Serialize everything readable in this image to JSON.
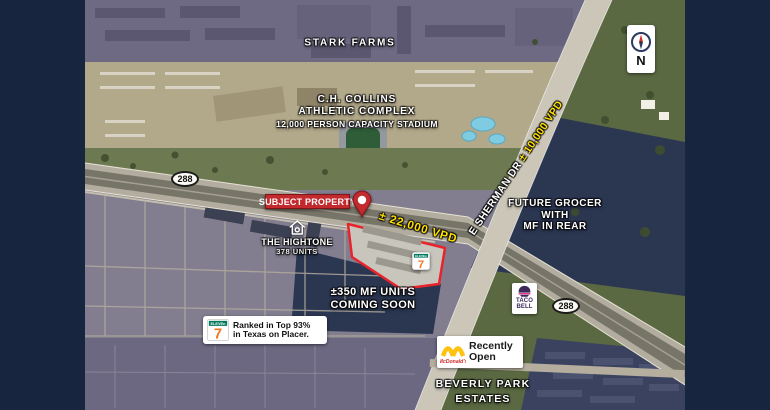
{
  "frame": {
    "border_color": "#17253e"
  },
  "labels": {
    "stark_farms": "STARK FARMS",
    "collins_line1": "C.H. COLLINS",
    "collins_line2": "ATHLETIC COMPLEX",
    "collins_line3": "12,000 PERSON CAPACITY STADIUM",
    "subject_property": "SUBJECT PROPERTY",
    "vpd_288": "± 22,000 VPD",
    "hightone_name": "THE HIGHTONE",
    "hightone_units": "378 UNITS",
    "sherman_name": "E SHERMAN DR",
    "sherman_vpd": " ± 10,000 VPD",
    "future_grocer_line1": "FUTURE GROCER",
    "future_grocer_line2": "WITH",
    "future_grocer_line3": "MF IN REAR",
    "mf_line1": "±350 MF UNITS",
    "mf_line2": "COMING SOON",
    "beverly_line1": "BEVERLY PARK",
    "beverly_line2": "ESTATES",
    "compass_n": "N"
  },
  "shields": {
    "route_288": "288"
  },
  "badges": {
    "placer_line1": "Ranked in Top 93%",
    "placer_line2": "in Texas on Placer.",
    "recently_line1": "Recently",
    "recently_line2": "Open"
  },
  "logos": {
    "seven_eleven_digit": "7",
    "seven_eleven_word": "ELEVEn",
    "taco_line1": "TACO",
    "taco_line2": "BELL",
    "mcdonalds_script": "McDonald's"
  },
  "colors": {
    "banner_red": "#c22a2e",
    "vpd_yellow": "#ffe100",
    "parcel_outline_red": "#e8242a",
    "navy_border": "#17253e",
    "seven_green": "#00795c",
    "seven_orange": "#ee7623",
    "taco_purple": "#3b2a5a",
    "mcd_yellow": "#ffc20e",
    "mcd_red": "#d02a2a"
  }
}
